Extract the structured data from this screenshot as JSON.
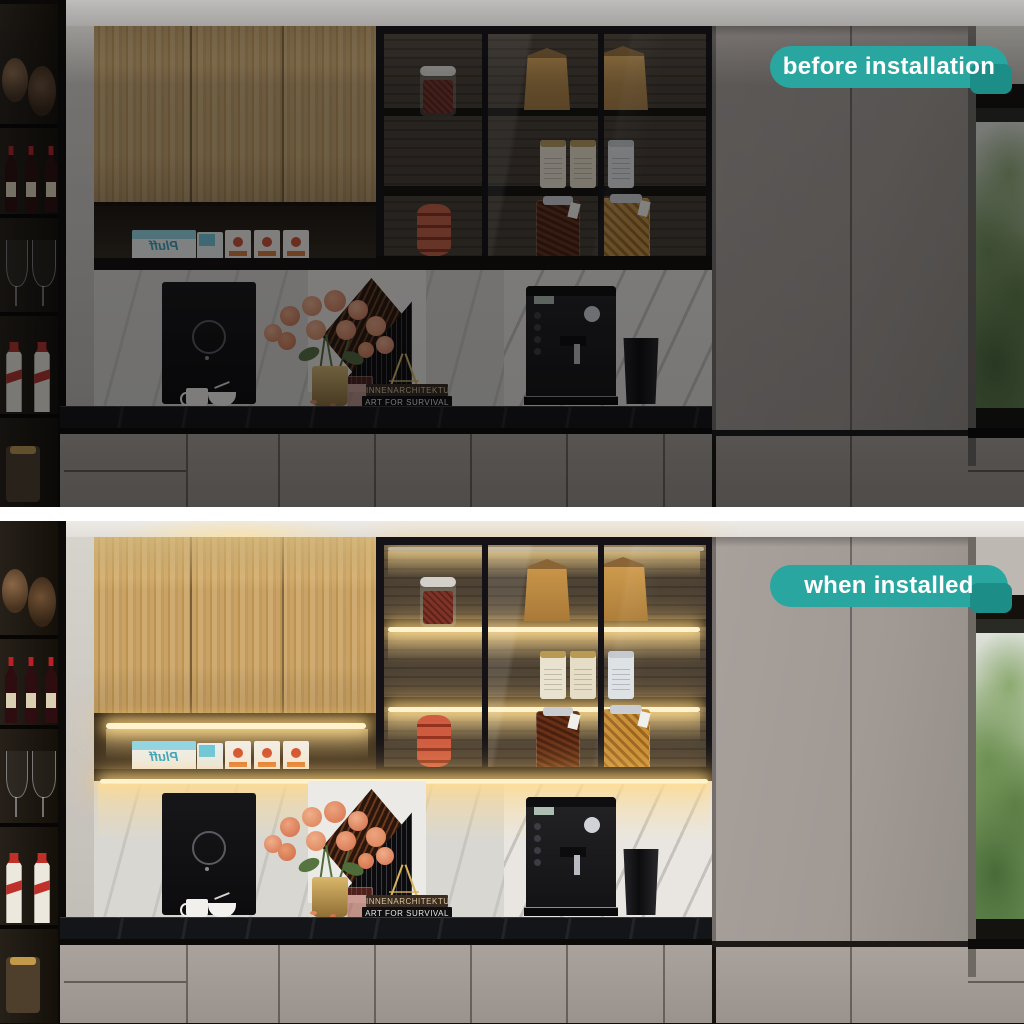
{
  "badges": {
    "before": "before installation",
    "after": "when installed"
  },
  "colors": {
    "badge_teal": "#2aa6a0",
    "led_warm": "#fff3cd",
    "wood_cabinet": "#c7a164",
    "tall_cabinet_gray": "#a29a94",
    "countertop_black": "#141519"
  },
  "scene": {
    "milk_box_label": "Pluff",
    "book_top_title": "INNENARCHITEKTUR",
    "book_bottom_title": "ART FOR SURVIVAL"
  }
}
